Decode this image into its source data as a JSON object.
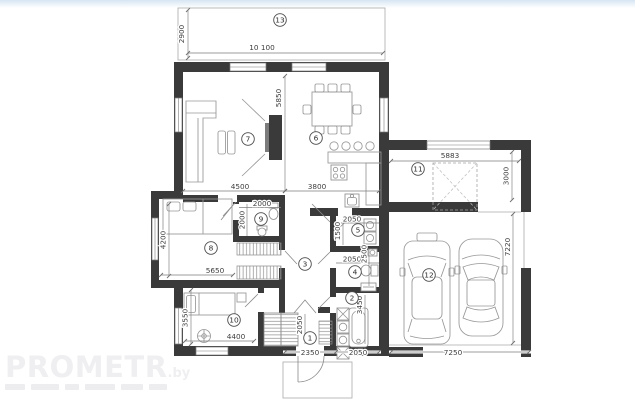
{
  "watermark": {
    "brand": "PROMETR",
    "suffix": ".by"
  },
  "rooms": [
    {
      "number": "1"
    },
    {
      "number": "2"
    },
    {
      "number": "3"
    },
    {
      "number": "4"
    },
    {
      "number": "5"
    },
    {
      "number": "6"
    },
    {
      "number": "7"
    },
    {
      "number": "8"
    },
    {
      "number": "9"
    },
    {
      "number": "10"
    },
    {
      "number": "11"
    },
    {
      "number": "12"
    },
    {
      "number": "13"
    }
  ],
  "dims": {
    "terrace_h": "2900",
    "terrace_w": "10 100",
    "living_h": "5850",
    "living_w": "4500",
    "dining_w": "3800",
    "carport_w": "5883",
    "carport_d": "3000",
    "garage_w": "7250",
    "garage_d": "7220",
    "bed1_h": "4200",
    "bed1_w": "5650",
    "wc1_w": "2000",
    "wc1_h": "2000",
    "pantry_w": "2050",
    "pantry_h": "1500",
    "wc2_w": "2050",
    "wc2_h": "2500",
    "bath_w": "2050",
    "bath_h": "3450",
    "hall_w": "2350",
    "hall_h": "2050",
    "bed2_w": "4400",
    "bed2_h": "3550"
  }
}
